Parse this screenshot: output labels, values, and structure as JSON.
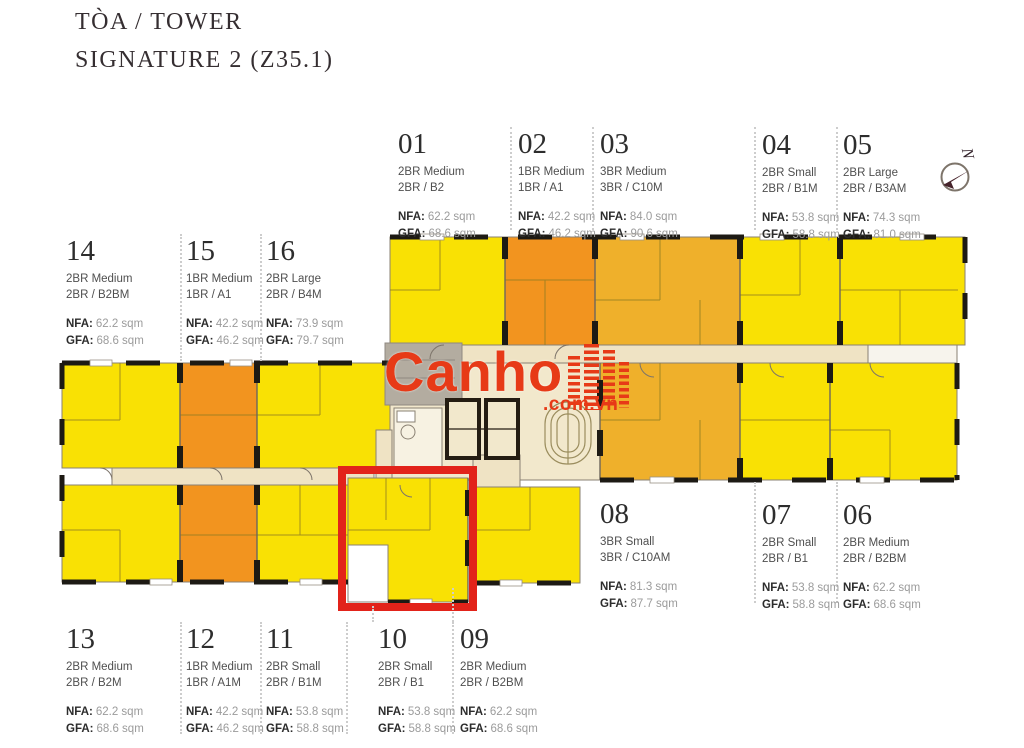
{
  "title": {
    "line1": "TÒA / TOWER",
    "line2": "SIGNATURE 2 (Z35.1)"
  },
  "field_labels": {
    "nfa": "NFA:",
    "gfa": "GFA:"
  },
  "watermark": {
    "brand": "Canho",
    "domain": ".com.vn",
    "color": "#e73a17"
  },
  "compass": {
    "letter": "N"
  },
  "highlight": {
    "unit": "10",
    "color": "#e2231a"
  },
  "palette": {
    "unit_yellow": "#f9e104",
    "unit_orange": "#f2941f",
    "unit_amber": "#efb02b",
    "corridor": "#efe3c4",
    "core": "#f2e8cc",
    "void_gray": "#b3aca0",
    "wall_black": "#1d1a14",
    "highlight_red": "#e2231a"
  },
  "units": [
    {
      "num": "01",
      "type": "2BR Medium",
      "code": "2BR / B2",
      "nfa": "62.2 sqm",
      "gfa": "68.6 sqm"
    },
    {
      "num": "02",
      "type": "1BR Medium",
      "code": "1BR / A1",
      "nfa": "42.2 sqm",
      "gfa": "46.2 sqm"
    },
    {
      "num": "03",
      "type": "3BR Medium",
      "code": "3BR / C10M",
      "nfa": "84.0 sqm",
      "gfa": "90.6 sqm"
    },
    {
      "num": "04",
      "type": "2BR Small",
      "code": "2BR / B1M",
      "nfa": "53.8 sqm",
      "gfa": "58.8 sqm"
    },
    {
      "num": "05",
      "type": "2BR Large",
      "code": "2BR / B3AM",
      "nfa": "74.3 sqm",
      "gfa": "81.0 sqm"
    },
    {
      "num": "06",
      "type": "2BR Medium",
      "code": "2BR / B2BM",
      "nfa": "62.2 sqm",
      "gfa": "68.6 sqm"
    },
    {
      "num": "07",
      "type": "2BR Small",
      "code": "2BR / B1",
      "nfa": "53.8 sqm",
      "gfa": "58.8 sqm"
    },
    {
      "num": "08",
      "type": "3BR Small",
      "code": "3BR / C10AM",
      "nfa": "81.3 sqm",
      "gfa": "87.7 sqm"
    },
    {
      "num": "09",
      "type": "2BR Medium",
      "code": "2BR / B2BM",
      "nfa": "62.2 sqm",
      "gfa": "68.6 sqm"
    },
    {
      "num": "10",
      "type": "2BR Small",
      "code": "2BR / B1",
      "nfa": "53.8 sqm",
      "gfa": "58.8 sqm"
    },
    {
      "num": "11",
      "type": "2BR Small",
      "code": "2BR / B1M",
      "nfa": "53.8 sqm",
      "gfa": "58.8 sqm"
    },
    {
      "num": "12",
      "type": "1BR Medium",
      "code": "1BR / A1M",
      "nfa": "42.2 sqm",
      "gfa": "46.2 sqm"
    },
    {
      "num": "13",
      "type": "2BR Medium",
      "code": "2BR / B2M",
      "nfa": "62.2 sqm",
      "gfa": "68.6 sqm"
    },
    {
      "num": "14",
      "type": "2BR Medium",
      "code": "2BR / B2BM",
      "nfa": "62.2 sqm",
      "gfa": "68.6 sqm"
    },
    {
      "num": "15",
      "type": "1BR Medium",
      "code": "1BR / A1",
      "nfa": "42.2 sqm",
      "gfa": "46.2 sqm"
    },
    {
      "num": "16",
      "type": "2BR Large",
      "code": "2BR / B4M",
      "nfa": "73.9 sqm",
      "gfa": "79.7 sqm"
    }
  ]
}
